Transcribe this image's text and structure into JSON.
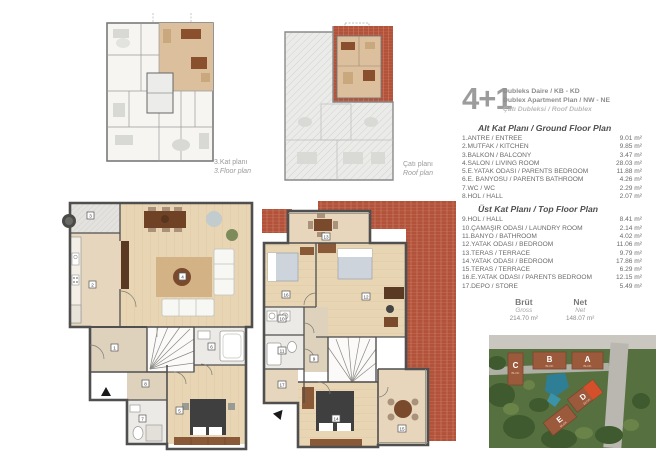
{
  "header": {
    "type_label": "4+1",
    "line1": "Dubleks Daire / KB - KD",
    "line2": "Dublex Apartment Plan / NW - NE",
    "line3": "Çatı Dubleksi / Roof Dublex"
  },
  "small_plans": {
    "floor3_label_tr": "3.Kat planı",
    "floor3_label_en": "3.Floor plan",
    "roof_label_tr": "Çatı planı",
    "roof_label_en": "Roof plan"
  },
  "ground_floor": {
    "title": "Alt Kat Planı / Ground Floor Plan",
    "rooms": [
      {
        "label": "1.ANTRE / ENTREE",
        "area": "9.01 m²"
      },
      {
        "label": "2.MUTFAK / KITCHEN",
        "area": "9.85 m²"
      },
      {
        "label": "3.BALKON / BALCONY",
        "area": "3.47 m²"
      },
      {
        "label": "4.SALON / LIVING ROOM",
        "area": "28.03 m²"
      },
      {
        "label": "5.E.YATAK ODASI / PARENTS BEDROOM",
        "area": "11.88 m²"
      },
      {
        "label": "6.E. BANYOSU / PARENTS BATHROOM",
        "area": "4.26 m²"
      },
      {
        "label": "7.WC / WC",
        "area": "2.29 m²"
      },
      {
        "label": "8.HOL / HALL",
        "area": "2.07 m²"
      }
    ]
  },
  "top_floor": {
    "title": "Üst Kat Planı / Top Floor Plan",
    "rooms": [
      {
        "label": "9.HOL / HALL",
        "area": "8.41 m²"
      },
      {
        "label": "10.ÇAMAŞIR ODASI / LAUNDRY ROOM",
        "area": "2.14 m²"
      },
      {
        "label": "11.BANYO / BATHROOM",
        "area": "4.02 m²"
      },
      {
        "label": "12.YATAK ODASI / BEDROOM",
        "area": "11.06 m²"
      },
      {
        "label": "13.TERAS / TERRACE",
        "area": "9.79 m²"
      },
      {
        "label": "14.YATAK ODASI / BEDROOM",
        "area": "17.86 m²"
      },
      {
        "label": "15.TERAS / TERRACE",
        "area": "6.29 m²"
      },
      {
        "label": "16.E.YATAK ODASI / PARENTS BEDROOM",
        "area": "12.15 m²"
      },
      {
        "label": "17.DEPO / STORE",
        "area": "5.49 m²"
      }
    ]
  },
  "totals": {
    "gross_label_tr": "Brüt",
    "gross_label_en": "Gross",
    "gross_value": "214.70 m²",
    "net_label_tr": "Net",
    "net_label_en": "Net",
    "net_value": "148.07 m²"
  },
  "site_plan": {
    "blocks": [
      {
        "letter": "A",
        "sub": "BLOK"
      },
      {
        "letter": "B",
        "sub": "BLOK"
      },
      {
        "letter": "C",
        "sub": "BLOK"
      },
      {
        "letter": "D",
        "sub": "BLOK"
      },
      {
        "letter": "E",
        "sub": "BLOK"
      }
    ]
  },
  "markers": {
    "ground": [
      "1",
      "2",
      "3",
      "4",
      "5",
      "6",
      "7",
      "8"
    ],
    "top": [
      "9",
      "10",
      "11",
      "12",
      "13",
      "14",
      "15",
      "16",
      "17"
    ]
  },
  "colors": {
    "roof_tile": "#b2523b",
    "highlight_unit": "#d9ba92",
    "wood_floor": "#e6d4b4",
    "wall": "#4f4f4f"
  }
}
